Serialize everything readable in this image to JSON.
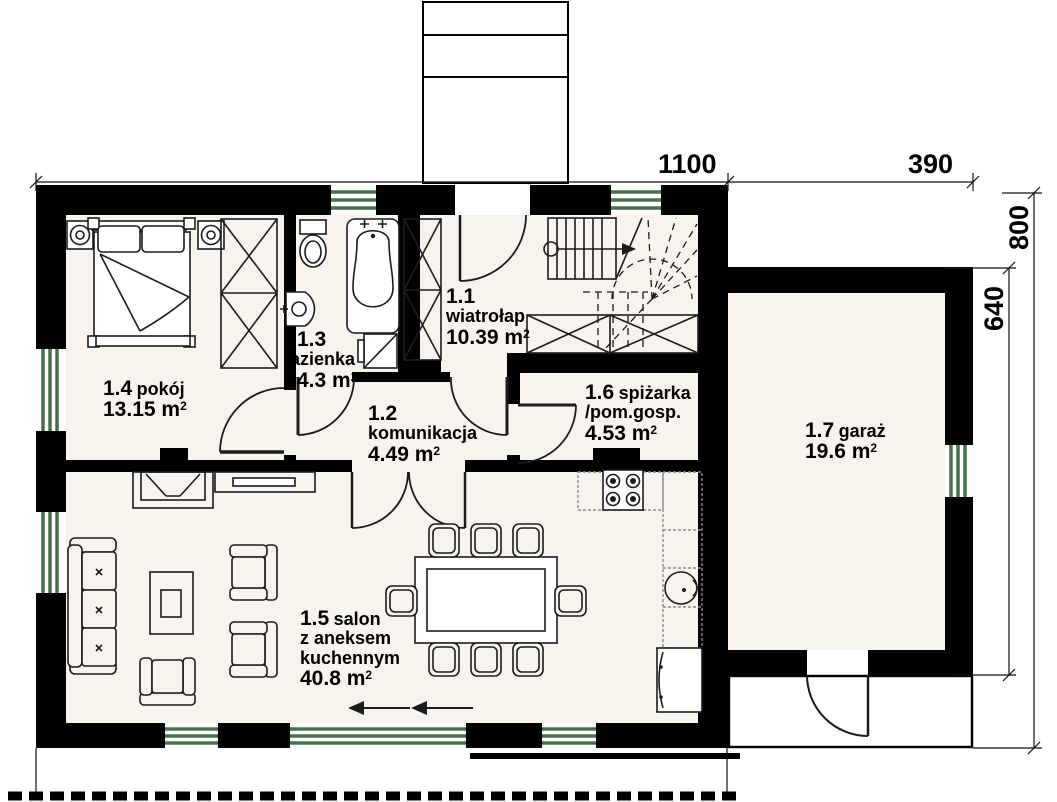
{
  "sup": "2",
  "rooms": {
    "wiatrolap": {
      "num": "1.1",
      "name": "wiatrołap",
      "area": "10.39 m"
    },
    "komunikacja": {
      "num": "1.2",
      "name": "komunikacja",
      "area": "4.49 m"
    },
    "lazienka": {
      "num": "1.3",
      "name": "łazienka",
      "area": "4.3 m"
    },
    "pokoj": {
      "num": "1.4",
      "name": "pokój",
      "area": "13.15 m"
    },
    "salon": {
      "num": "1.5",
      "name": "salon",
      "name2": "z aneksem",
      "name3": "kuchennym",
      "area": "40.8 m"
    },
    "spizarka": {
      "num": "1.6",
      "name": "spiżarka",
      "name2": "/pom.gosp.",
      "area": "4.53 m"
    },
    "garaz": {
      "num": "1.7",
      "name": "garaż",
      "area": "19.6 m"
    }
  },
  "dimensions": {
    "house_width": "1100",
    "garage_width": "390",
    "house_depth": "800",
    "garage_depth": "640"
  },
  "colors": {
    "wall": "#000000",
    "window": "#47714a",
    "floor": "#f8f3ed",
    "outline": "#1c1c1c"
  }
}
